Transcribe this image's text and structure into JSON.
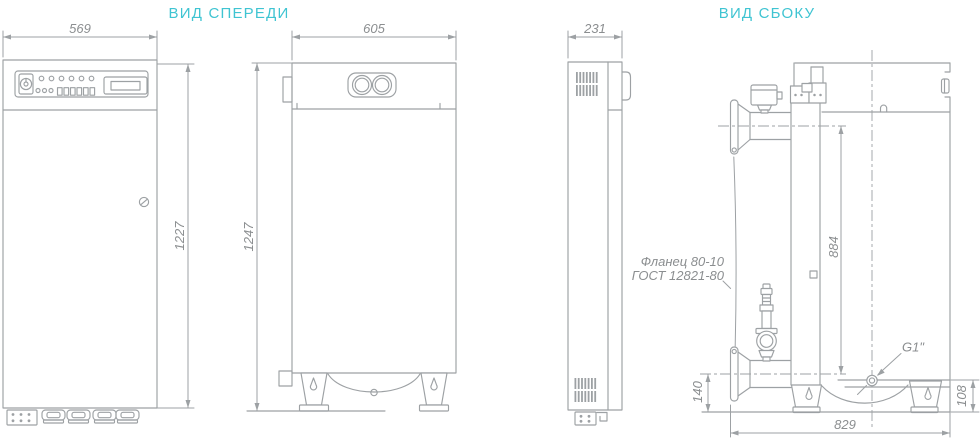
{
  "colors": {
    "line": "#9da1a4",
    "dim-text": "#8b8e90",
    "accent": "#3fc4d2",
    "background": "#ffffff"
  },
  "titles": {
    "front_view": "ВИД СПЕРЕДИ",
    "side_view": "ВИД СБОКУ"
  },
  "dimensions": {
    "control_cabinet_width": "569",
    "control_cabinet_height": "1227",
    "boiler_width": "605",
    "boiler_height": "1247",
    "control_cabinet_depth": "231",
    "pipe_axis_spacing": "884",
    "lower_pipe_axis_height": "140",
    "boiler_depth": "829",
    "drain_axis_height": "108"
  },
  "labels": {
    "flange_note_line1": "Фланец 80-10",
    "flange_note_line2": "ГОСТ 12821-80",
    "drain_thread": "G1\""
  }
}
